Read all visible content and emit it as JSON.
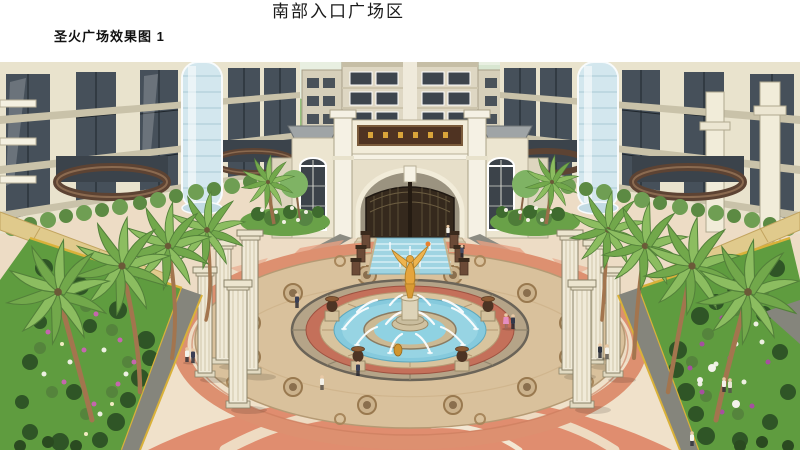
{
  "page": {
    "title": "南部入口广场区",
    "caption": "圣火广场效果图  1",
    "background_color": "#ffffff",
    "text_color": "#1a1a1a"
  },
  "rendering": {
    "palette": {
      "sky": "#e8efe1",
      "foliage": "#8cbd60",
      "palm_trunk": "#a3754e",
      "building_cream": "#e9e3cd",
      "glass": "#46505a",
      "glass_elevator": "#d3e7ee",
      "balcony_brown": "#5d4333",
      "gate_wall": "#ece5d0",
      "gate_plaque_bg": "#4f3322",
      "plaque_gold": "#d9a43a",
      "gate_doors": "#35291d",
      "plaza_paving": "#eddcc5",
      "path_red": "#dd9070",
      "mosaic_tan": "#d9c19c",
      "water_blue": "#86cadd",
      "statue_gold": "#e5a53c",
      "lawn_green": "#5f9c3f",
      "curb_yellow": "#d9b13a",
      "path_grey": "#85857c",
      "flower_pink": "#c566ae"
    }
  }
}
